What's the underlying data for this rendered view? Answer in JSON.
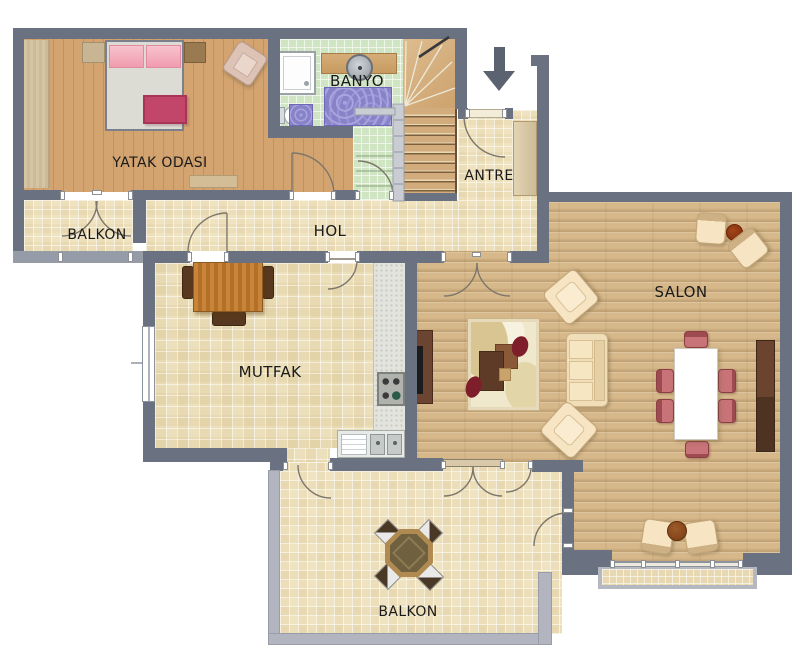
{
  "floorplan": {
    "title": "apartment-floor-plan",
    "rooms": [
      {
        "id": "yatak-odasi",
        "label": "YATAK ODASI"
      },
      {
        "id": "banyo",
        "label": "BANYO"
      },
      {
        "id": "antre",
        "label": "ANTRE"
      },
      {
        "id": "balkon-ust",
        "label": "BALKON"
      },
      {
        "id": "hol",
        "label": "HOL"
      },
      {
        "id": "mutfak",
        "label": "MUTFAK"
      },
      {
        "id": "salon",
        "label": "SALON"
      },
      {
        "id": "balkon-alt",
        "label": "BALKON"
      }
    ],
    "icons": {
      "entry_arrow": "down-arrow"
    },
    "palette": {
      "wall": "#6a7181",
      "wall_light": "#b2b5bf",
      "tile_floor": "#efe3c1",
      "bedroom_wood": "#d0a06a",
      "salon_wood": "#d6b88a",
      "bath_floor": "#cfe5c3",
      "dining_chair_pink": "#c77377",
      "rug_red": "#7e1e2a",
      "bed_blanket": "#c2456a"
    }
  }
}
